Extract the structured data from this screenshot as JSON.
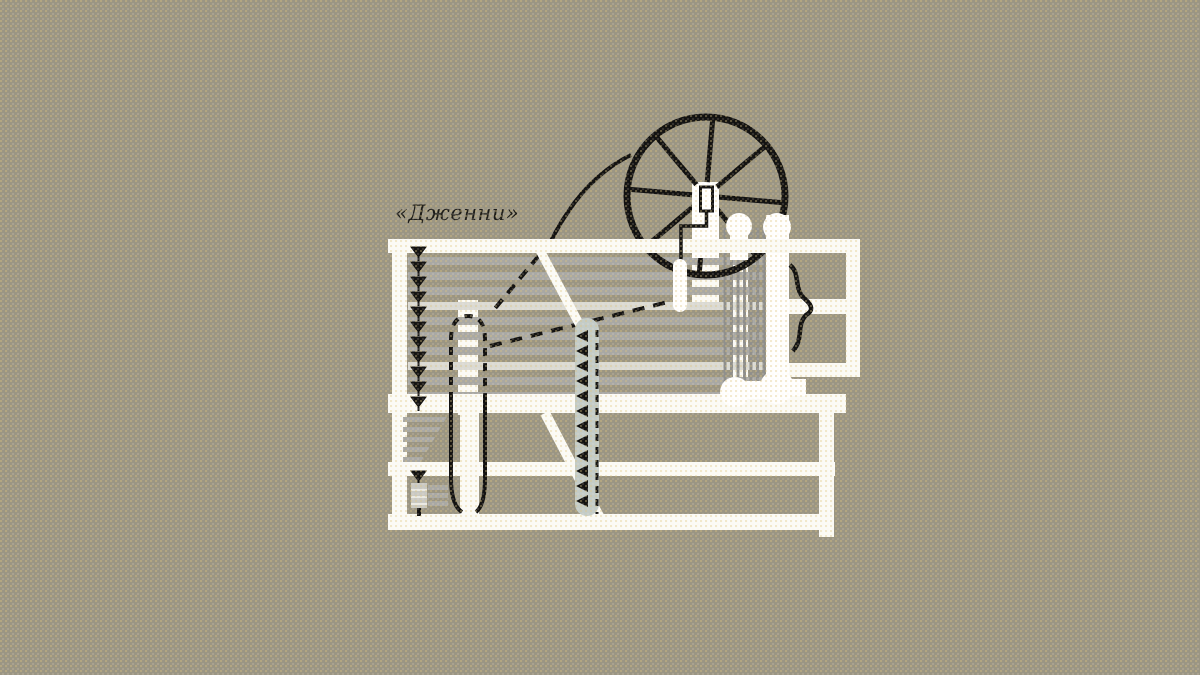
{
  "illustration": {
    "label": "«Дженни»",
    "colors": {
      "background": "#9a9583",
      "machine_white": "#fbfbf7",
      "ink_black": "#111111",
      "thread_gray": "#a8a8a4",
      "thread_light": "#dadad4",
      "creel_gray": "#8f8f8c",
      "cop_blue_gray": "#c3ccc8",
      "bobbin_gray": "#c9c9c4"
    }
  },
  "machine": {
    "wheel": {
      "spoke_count": 8
    },
    "thread_bank": {
      "row_count": 10,
      "light_rows": [
        3,
        7
      ]
    },
    "left_pin_count": 11,
    "lower_pin_count": 1,
    "creel_line_count": 7,
    "cop_pin_count": 12,
    "under_table_row_count": 5,
    "bobbin_stripe_count": 3
  }
}
